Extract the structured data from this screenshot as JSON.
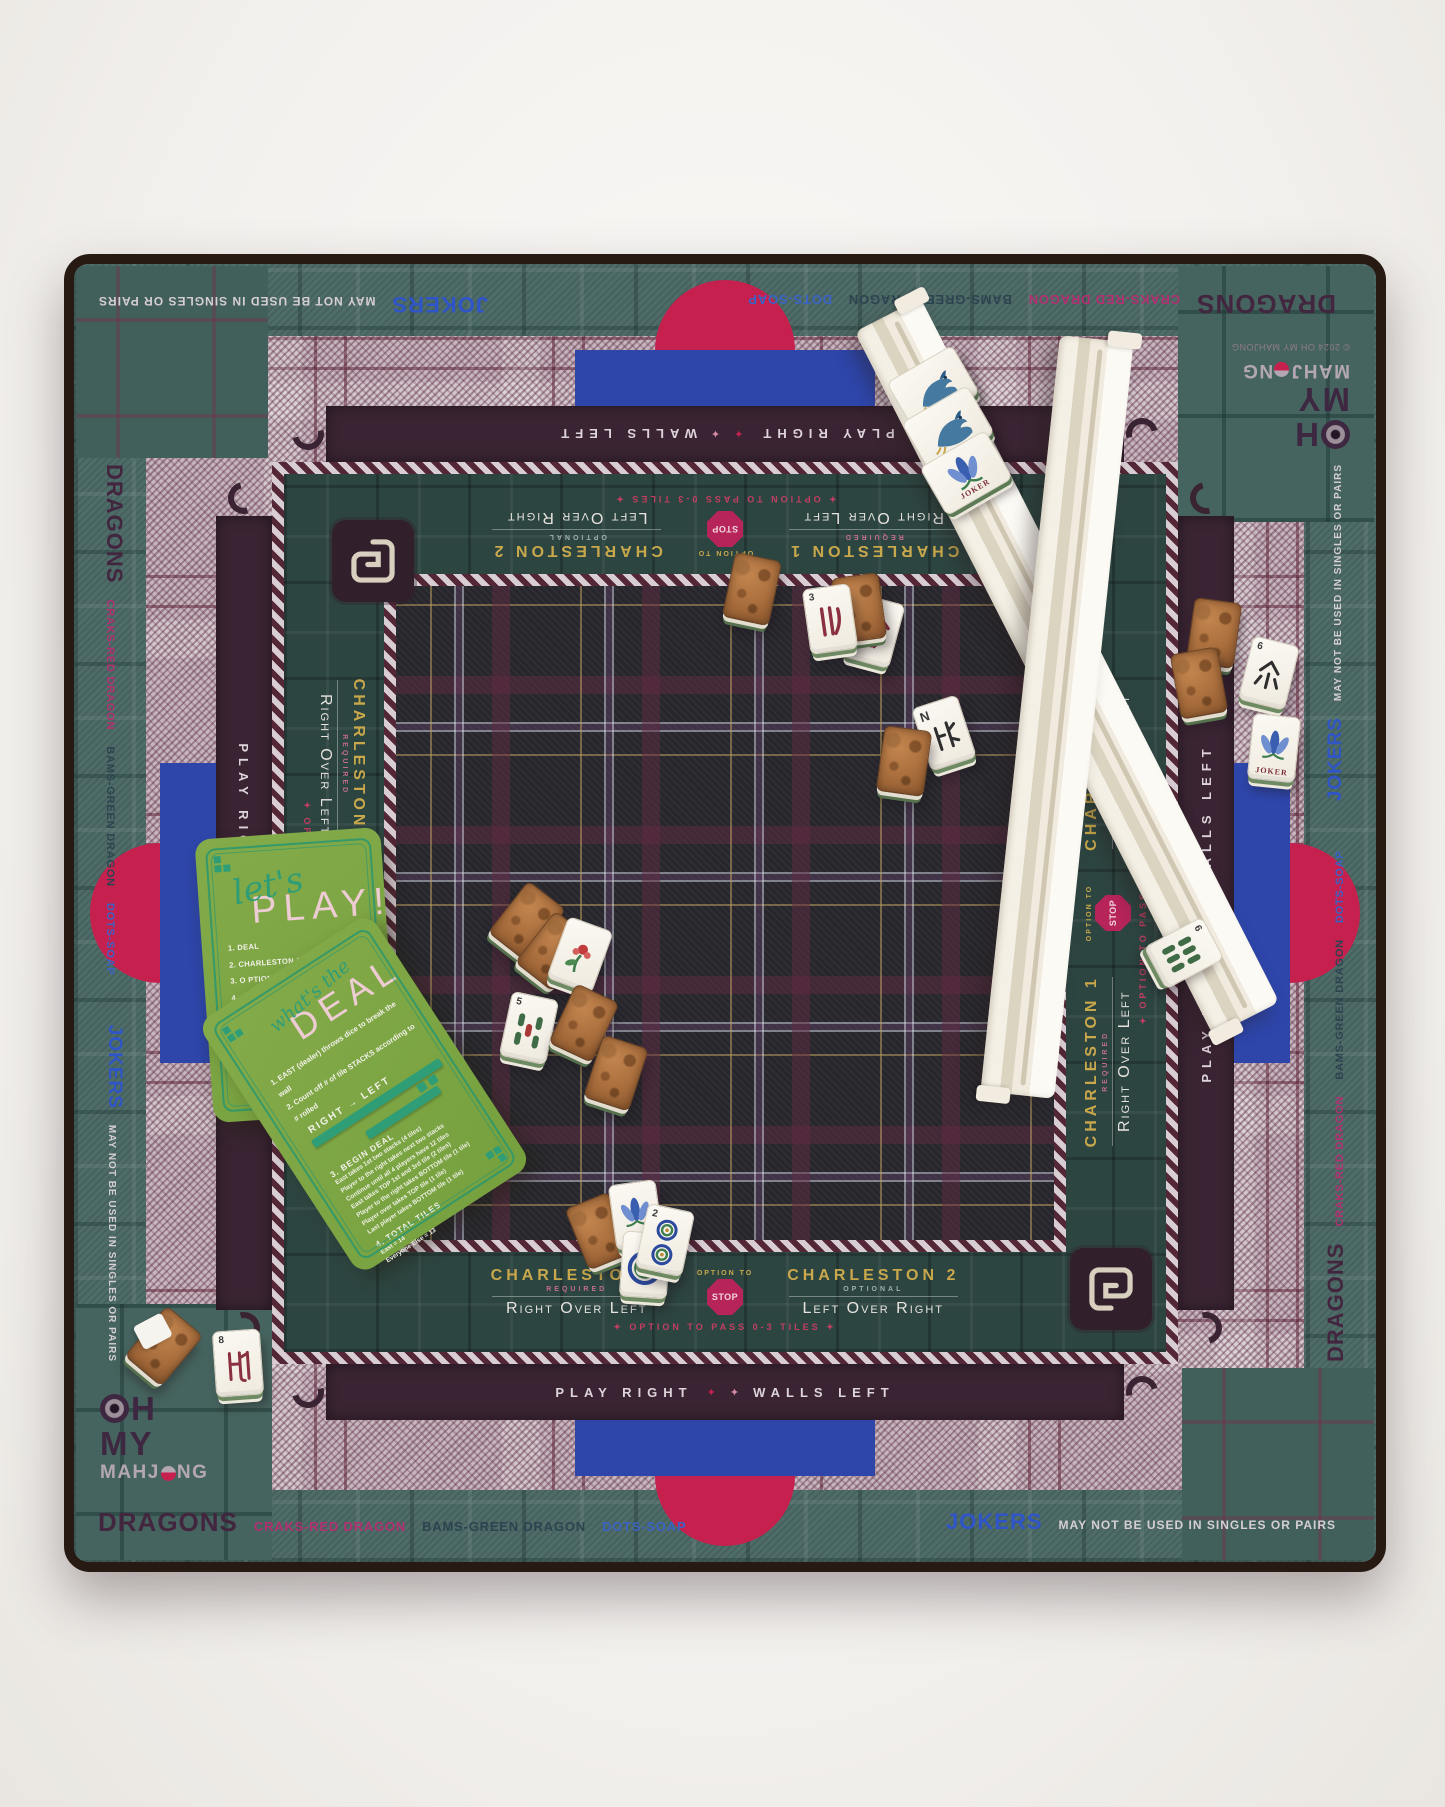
{
  "mat": {
    "edge": {
      "dragons": "DRAGONS",
      "craks": "CRAKS-RED DRAGON",
      "bams": "BAMS-GREEN DRAGON",
      "dots": "DOTS-SOAP",
      "jokers": "JOKERS",
      "jokers_note": "MAY NOT BE USED IN SINGLES OR PAIRS"
    },
    "logo": {
      "line1_rest": "H",
      "line2": "MY",
      "line3_a": "MAHJ",
      "line3_b": "NG",
      "copyright": "© 2024 OH MY MAHJONG"
    },
    "play_band": {
      "left": "PLAY RIGHT",
      "d1": "✦",
      "d2": "✦",
      "right": "WALLS LEFT"
    },
    "charleston": {
      "c1_title": "CHARLESTON 1",
      "c1_sub": "REQUIRED",
      "c1_dir": "Right Over Left",
      "option_to": "OPTION TO",
      "stop": "STOP",
      "c2_title": "CHARLESTON 2",
      "c2_sub": "OPTIONAL",
      "c2_dir": "Left Over Right",
      "pass_line": "✦ OPTION TO PASS 0-3 TILES ✦"
    }
  },
  "cards": {
    "play": {
      "script": "let's",
      "title": "PLAY!",
      "items": [
        "1. DEAL",
        "2. CHARLESTON 1 (REQUIRED)",
        "3. O PTION TO STOP CHARLESTON (ANY PLAYER)",
        "4. CHARLESTON 2 (OPTIONAL)",
        "5. OPTIONAL COURTESY PASS WITH ACROSS (0-3 TILES)",
        "6. DEALER (EAST) DISCARDS 1 TILE",
        "7. PLAYER TO RIGHT DRAWS NEXT"
      ],
      "signature": "there you go!"
    },
    "deal": {
      "script": "what's the",
      "title": "DEAL",
      "step1": "1. EAST (dealer) throws dice to break the wall",
      "step2": "2. Count off # of tile STACKS according to # rolled",
      "direction": "RIGHT → LEFT",
      "begin_title": "3. BEGIN DEAL",
      "begin_lines": [
        "East takes 1st two stacks (4 tiles)",
        "Player to the right takes next two stacks",
        "Continue until all 4 players have 12 tiles",
        "East takes TOP 1st and 3rd tile (2 tiles)",
        "Player to the right takes BOTTOM tile (1 tile)",
        "Player over takes TOP tile (1 tile)",
        "Last player takes BOTTOM tile (1 tile)"
      ],
      "total_title": "4. TOTAL TILES",
      "total_lines": [
        "East = 14",
        "Everyone Else = 13"
      ]
    }
  },
  "tiles": {
    "crak3": "3",
    "crak6": "6",
    "crak8": "8",
    "bam5": "5",
    "bam6": "6",
    "dot2": "2",
    "north": "N",
    "joker": "JOKER"
  }
}
